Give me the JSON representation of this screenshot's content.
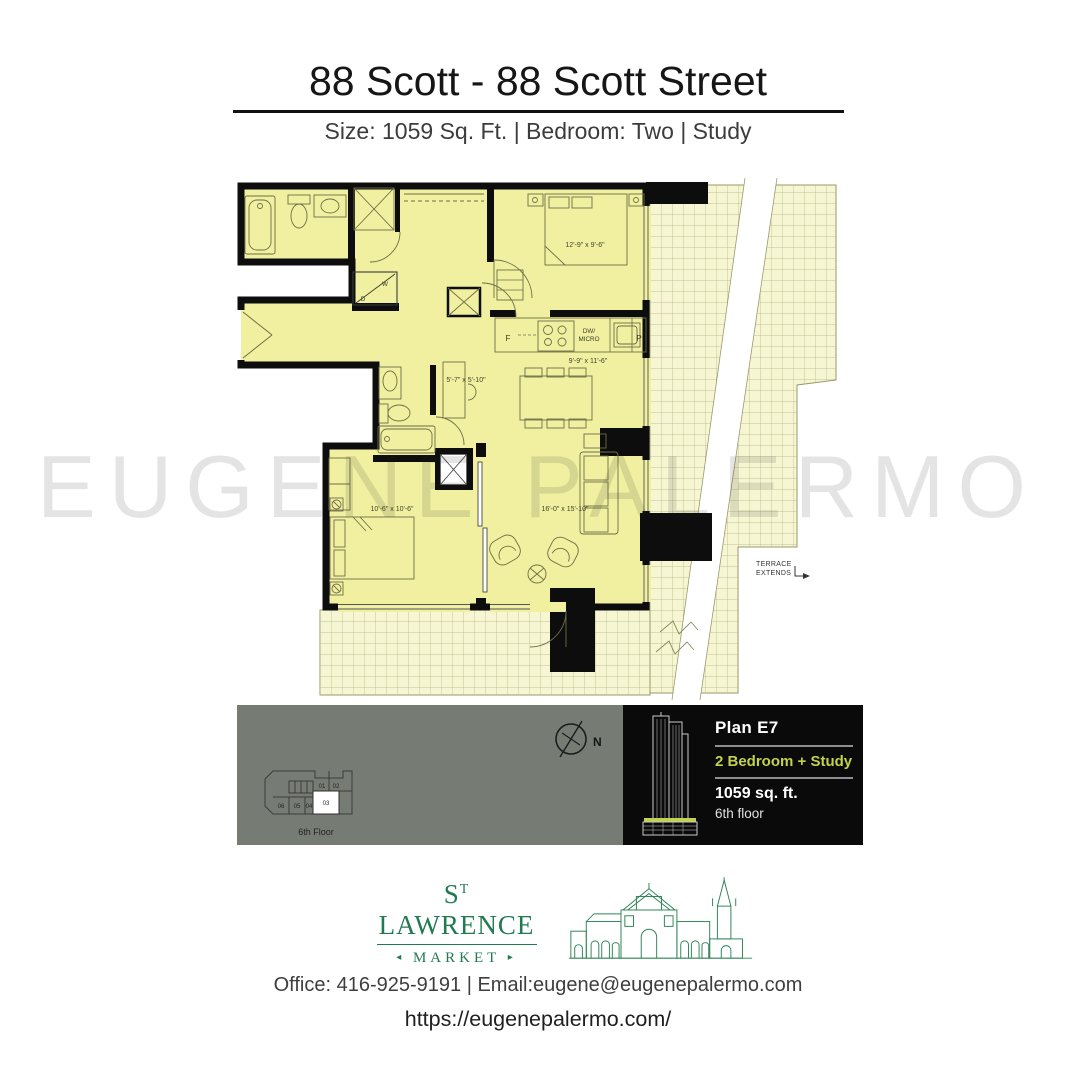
{
  "header": {
    "title": "88 Scott - 88 Scott Street",
    "subtitle": "Size: 1059 Sq. Ft. |  Bedroom: Two  |  Study"
  },
  "watermark": "EUGENE PALERMO",
  "plan": {
    "dims": {
      "bedroom1": "12'-9\" x 9'-6\"",
      "kitchen_dining": "9'-9\" x 11'-6\"",
      "study": "5'-7\" x 5'-10\"",
      "bedroom2": "10'-6\" x 10'-6\"",
      "living": "16'-0\" x 15'-10\""
    },
    "labels": {
      "fridge": "F",
      "dw": "DW/",
      "micro": "MICRO",
      "pantry": "P",
      "washer": "W",
      "dryer": "D",
      "terrace_note_1": "TERRACE",
      "terrace_note_2": "EXTENDS"
    },
    "colors": {
      "floor": "#f0f0a0",
      "terrace": "#f6f6d2",
      "wall": "#0d0d0d"
    }
  },
  "keyplan": {
    "floor_label": "6th Floor",
    "units_top": [
      "01",
      "02"
    ],
    "units_bottom": [
      "06",
      "05",
      "04",
      "03"
    ],
    "highlighted_unit": "03"
  },
  "compass": {
    "north_label": "N"
  },
  "info_panel": {
    "plan_name": "Plan E7",
    "unit_type": "2 Bedroom + Study",
    "size": "1059 sq. ft.",
    "floor": "6th floor",
    "accent_color": "#c2d24b"
  },
  "brand": {
    "name_s": "S",
    "name_sup": "T",
    "name_rest": " LAWRENCE",
    "market": "MARKET",
    "arrow_left": "◂",
    "arrow_right": "▸",
    "color": "#217a50"
  },
  "footer": {
    "contact": "Office: 416-925-9191  |  Email:eugene@eugenepalermo.com",
    "website": "https://eugenepalermo.com/"
  }
}
